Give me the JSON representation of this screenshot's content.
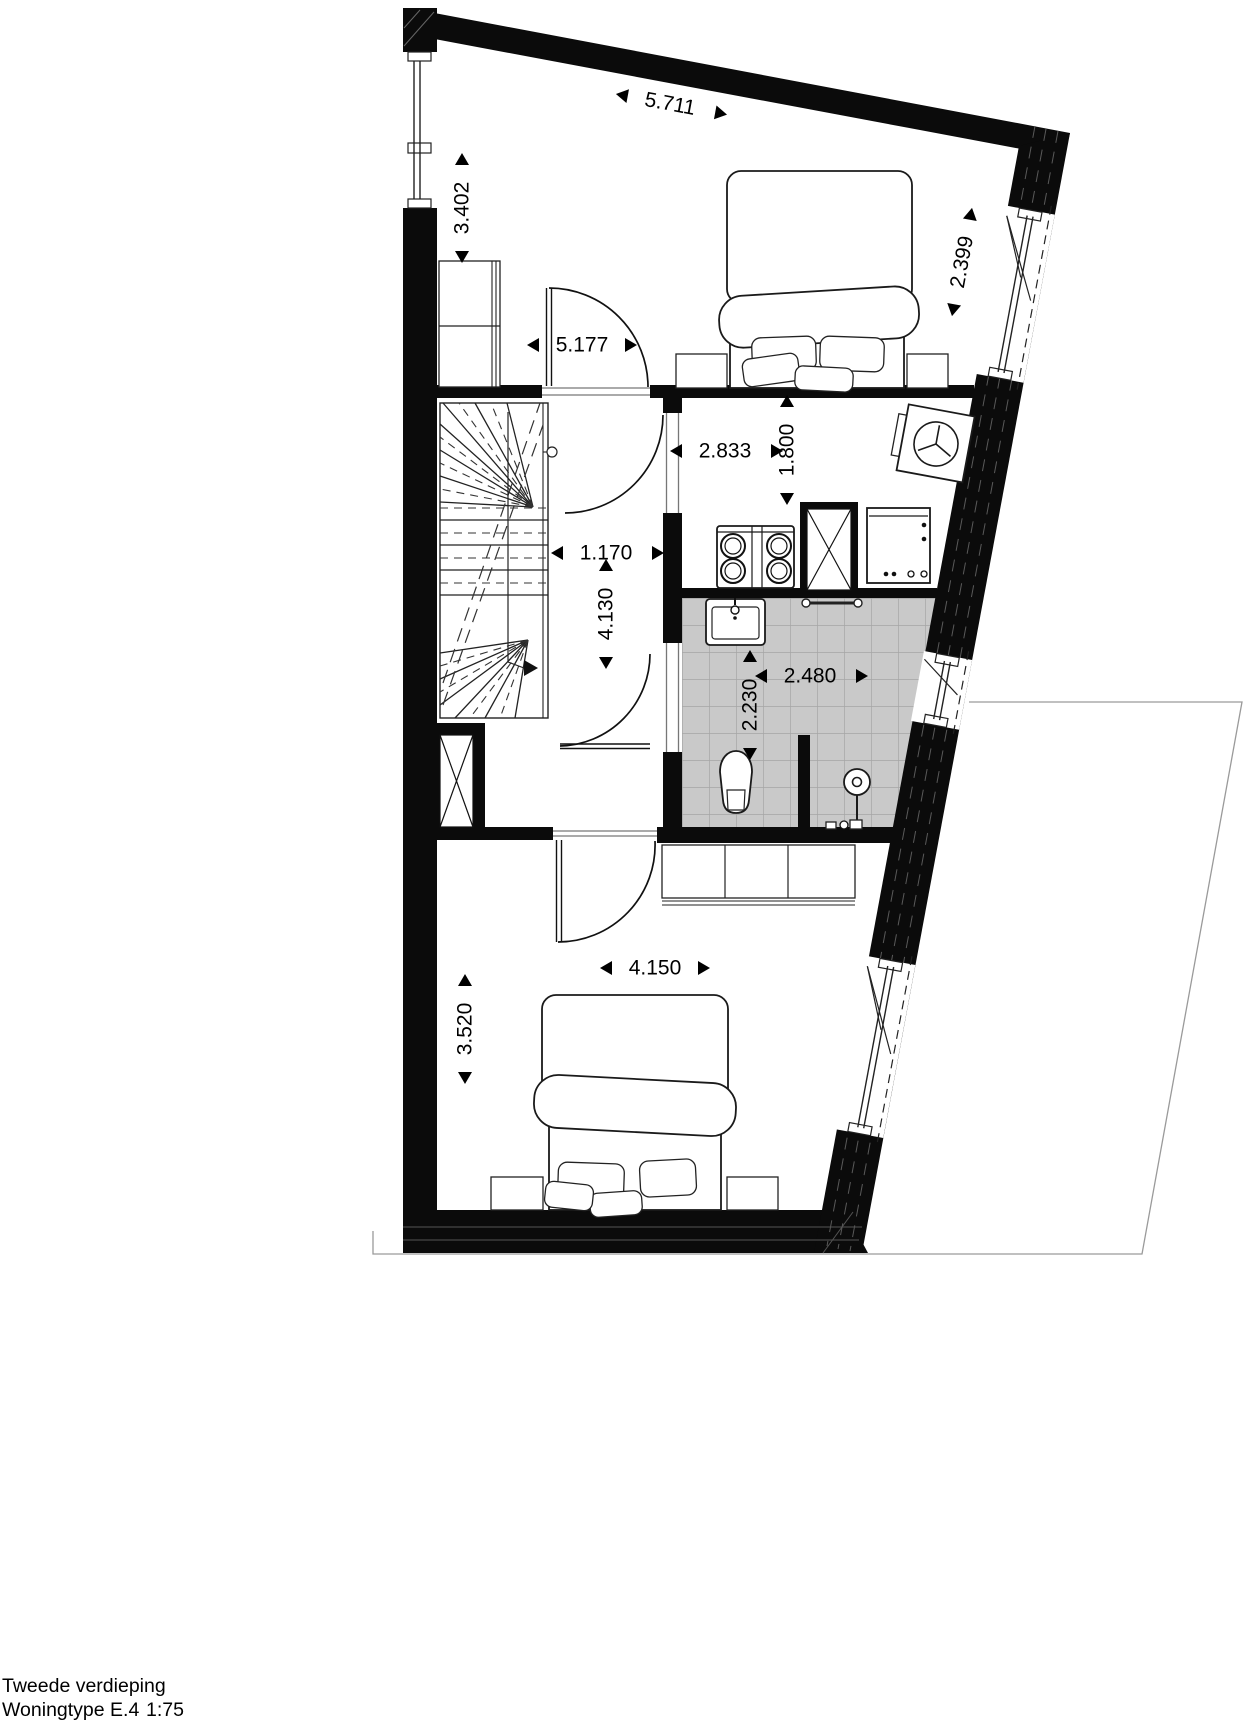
{
  "title": {
    "floor": "Tweede verdieping",
    "unit_type": "Woningtype E.4",
    "scale": "1:75"
  },
  "colors": {
    "wall": "#0b0b0b",
    "tile_fill": "#c9c9c9",
    "tile_grid": "#a6a6a6",
    "plot_outline": "#9a9a9a"
  },
  "dimensions": {
    "top_width": {
      "value": "5.711"
    },
    "left_upper_height": {
      "value": "3.402"
    },
    "right_upper_height": {
      "value": "2.399"
    },
    "bedroom1_width": {
      "value": "5.177"
    },
    "techroom_width": {
      "value": "2.833"
    },
    "techroom_depth": {
      "value": "1.800"
    },
    "hallway_width": {
      "value": "1.170"
    },
    "hallway_depth": {
      "value": "4.130"
    },
    "bathroom_width": {
      "value": "2.480"
    },
    "bathroom_depth": {
      "value": "2.230"
    },
    "bedroom2_width": {
      "value": "4.150"
    },
    "bedroom2_height": {
      "value": "3.520"
    }
  }
}
